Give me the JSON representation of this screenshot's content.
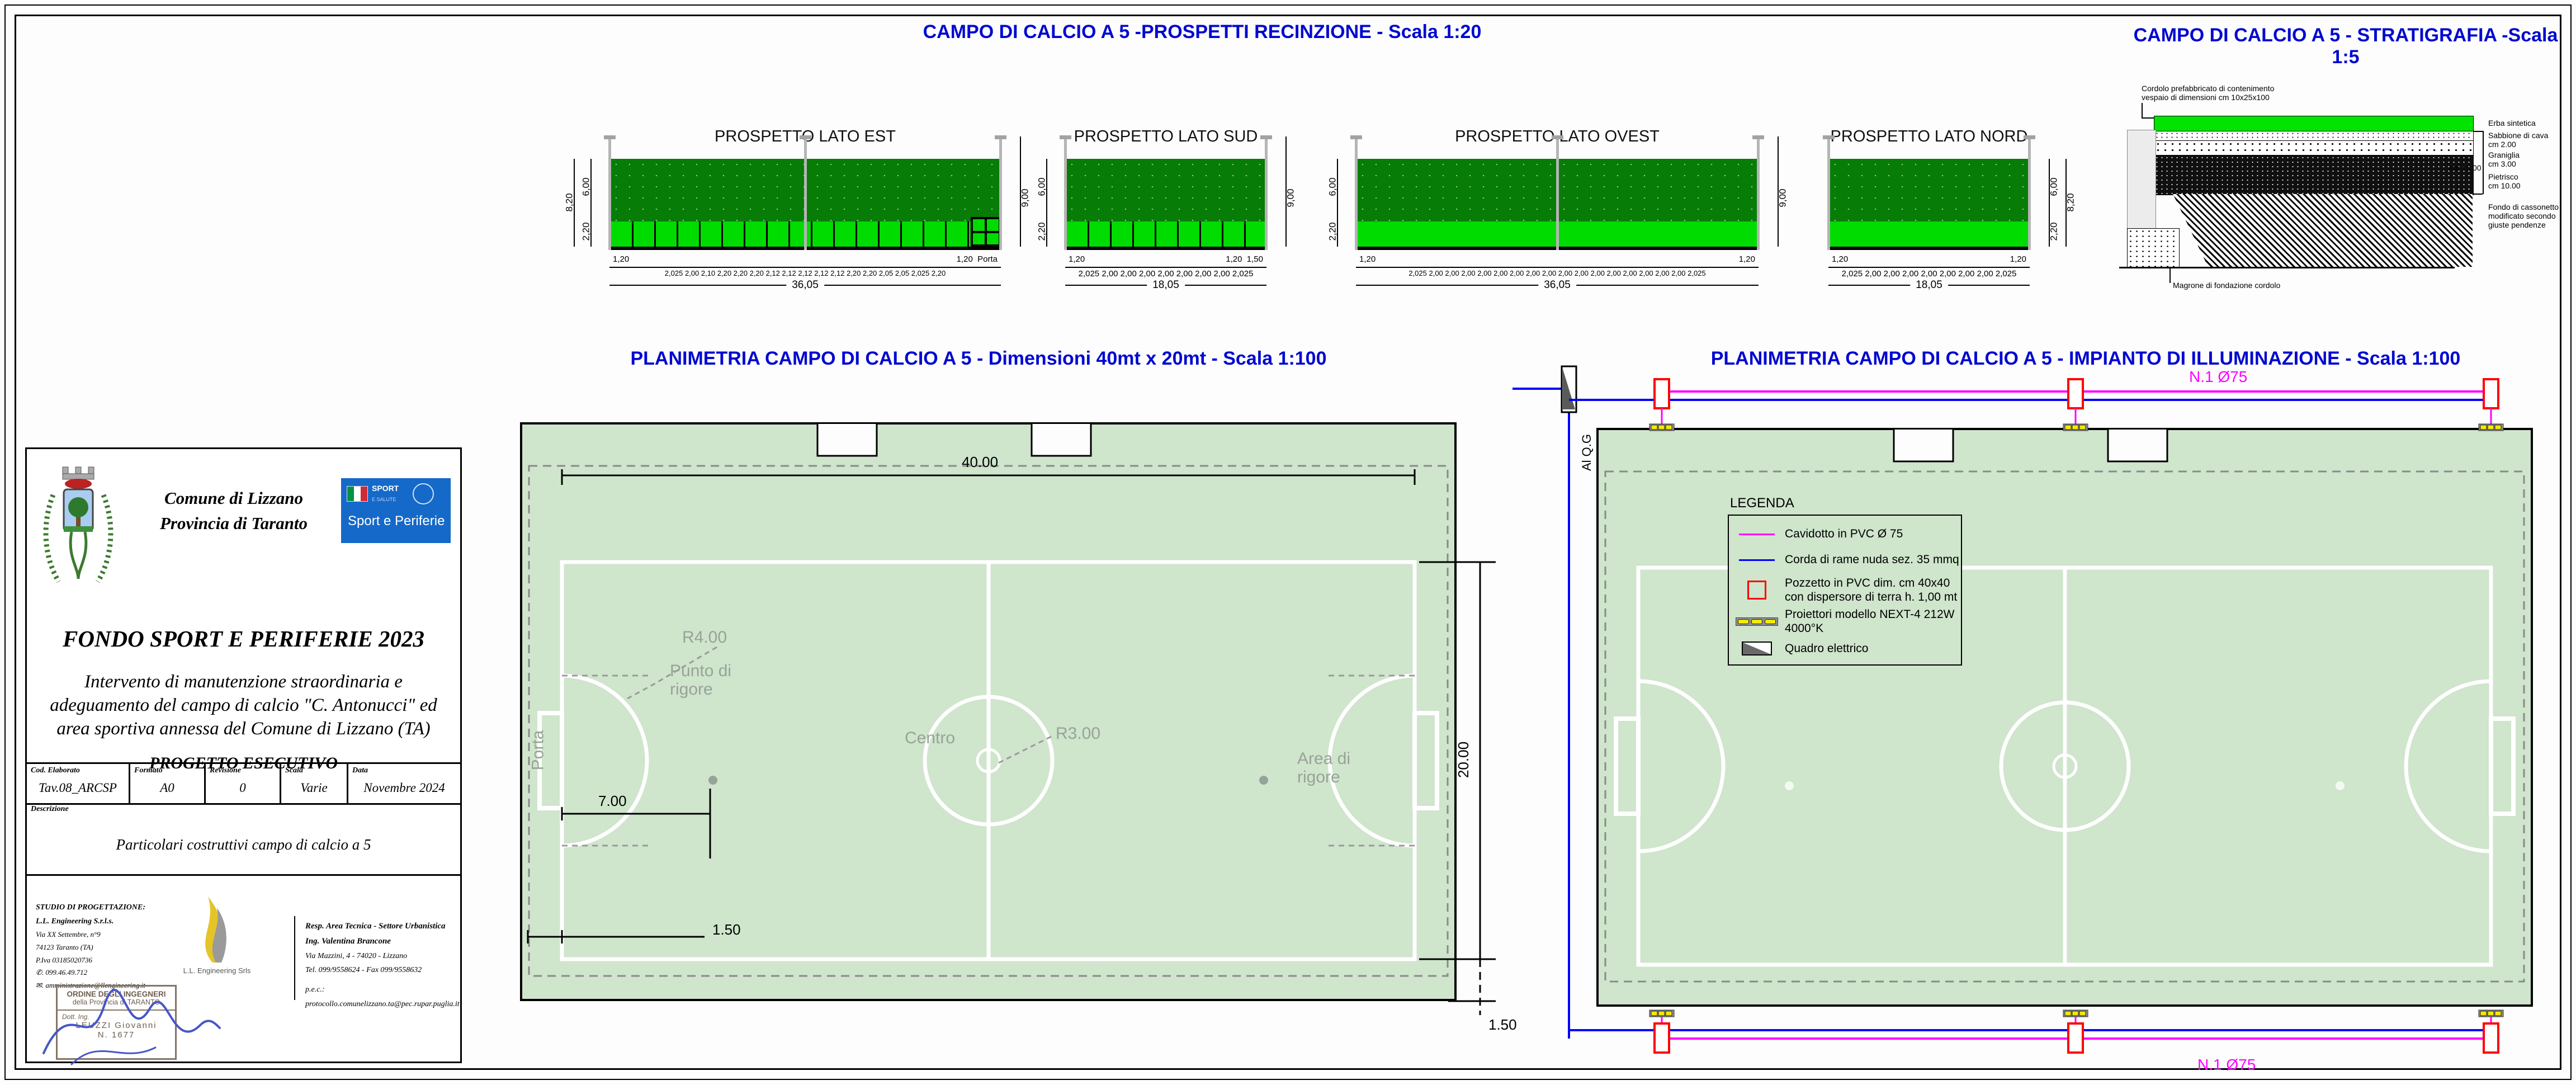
{
  "titles": {
    "prospetti": "CAMPO DI CALCIO A 5  -PROSPETTI RECINZIONE - Scala 1:20",
    "stratigrafia": "CAMPO DI CALCIO A 5 - STRATIGRAFIA -Scala 1:5",
    "planimetria": "PLANIMETRIA CAMPO DI CALCIO A 5 - Dimensioni 40mt x 20mt - Scala 1:100",
    "illuminazione": "PLANIMETRIA CAMPO DI CALCIO A 5 - IMPIANTO DI ILLUMINAZIONE - Scala 1:100"
  },
  "elevations": [
    {
      "title": "PROSPETTO LATO EST",
      "h_total": "8,20",
      "h_top": "6,00",
      "h_bottom": "2,20",
      "h_pole": "9,00",
      "module": "1,20",
      "extra": "Porta",
      "segments": "2,025  2,00  2,10  2,20  2,20  2,20  2,12  2,12  2,12  2,12  2,12  2,20  2,20  2,05  2,05  2,025  2,20",
      "w_total": "36,05"
    },
    {
      "title": "PROSPETTO LATO SUD",
      "h_total": "8,20",
      "h_top": "6,00",
      "h_bottom": "2,20",
      "h_pole": "9,00",
      "module": "1,20",
      "extra": "1,50",
      "segments": "2,025  2,00  2,00  2,00  2,00  2,00  2,00  2,00  2,025",
      "w_total": "18,05"
    },
    {
      "title": "PROSPETTO LATO OVEST",
      "h_total": "8,20",
      "h_top": "6,00",
      "h_bottom": "2,20",
      "h_pole": "9,00",
      "module": "1,20",
      "extra": "1,20",
      "segments": "2,025  2,00  2,00  2,00  2,00  2,00  2,00  2,00  2,00  2,00  2,00  2,00  2,00  2,00  2,00  2,00  2,00  2,025",
      "w_total": "36,05"
    },
    {
      "title": "PROSPETTO LATO NORD",
      "h_total": "8,20",
      "h_top": "6,00",
      "h_bottom": "2,20",
      "h_pole": "9,00",
      "module": "1,20",
      "extra": "1,20",
      "segments": "2,025  2,00  2,00  2,00  2,00  2,00  2,00  2,00  2,025",
      "w_total": "18,05"
    }
  ],
  "stratigraphy": {
    "label_cordolo": "Cordolo prefabbricato di contenimento\nvespaio di dimensioni cm 10x25x100",
    "layer_erba": "Erba sintetica",
    "layer_sabbione": "Sabbione di cava\ncm 2.00",
    "layer_graniglia": "Graniglia\ncm 3.00",
    "dim_totale": "cm 15.00",
    "layer_pietrisco": "Pietrisco\ncm 10.00",
    "label_fondo": "Fondo di cassonetto\nmodificato secondo\ngiuste pendenze",
    "label_magrone": "Magrone di fondazione cordolo"
  },
  "plan": {
    "porta": "Porta",
    "punto_di_rigore": "Punto di\nrigore",
    "centro": "Centro",
    "r3": "R3.00",
    "r4": "R4.00",
    "area_di_rigore": "Area di\nrigore",
    "dim_larghezza": "40.00",
    "dim_altezza": "20.00",
    "dim_punto": "7.00",
    "dim_fascia_sx": "1.50",
    "dim_fascia_basso": "1.50"
  },
  "lighting": {
    "quadro_label": "Al  Q.G",
    "cavidotto_top": "N.1 Ø75",
    "cavidotto_bottom": "N.1 Ø75",
    "legend": {
      "title": "LEGENDA",
      "items": [
        {
          "label": "Cavidotto in PVC Ø 75"
        },
        {
          "label": "Corda di rame nuda sez. 35 mmq"
        },
        {
          "label": "Pozzetto in PVC dim. cm 40x40",
          "label2": "con dispersore di terra h. 1,00 mt"
        },
        {
          "label": "Proiettori modello NEXT-4 212W 4000°K"
        },
        {
          "label": "Quadro elettrico"
        }
      ]
    }
  },
  "titleblock": {
    "comune": "Comune di Lizzano",
    "provincia": "Provincia di Taranto",
    "logo_line1": "SPORT",
    "logo_line2": "E SALUTE",
    "logo_text": "Sport e Periferie",
    "fondo": "FONDO SPORT E PERIFERIE 2023",
    "intervento": "Intervento di manutenzione straordinaria e\nadeguamento del campo di calcio \"C. Antonucci\" ed\narea sportiva annessa del Comune di Lizzano (TA)",
    "progetto": "PROGETTO ESECUTIVO",
    "campi": {
      "cod_label": "Cod. Elaborato",
      "cod": "Tav.08_ARCSP",
      "formato_label": "Formato",
      "formato": "A0",
      "revisione_label": "Revisione",
      "revisione": "0",
      "scala_label": "Scala",
      "scala": "Varie",
      "data_label": "Data",
      "data": "Novembre 2024"
    },
    "descrizione_label": "Descrizione",
    "descrizione": "Particolari costruttivi campo di calcio a 5",
    "studio": {
      "titolo": "STUDIO DI PROGETTAZIONE:",
      "nome": "L.L. Engineering S.r.l.s.",
      "via": "Via XX Settembre, n°9",
      "citta": "74123 Taranto (TA)",
      "piva": "P.Iva 03185020736",
      "tel": "✆. 099.46.49.712",
      "mail": "✉. amministrazione@llengineering.it",
      "logo_caption": "L.L. Engineering Srls"
    },
    "timbro": {
      "riga1": "ORDINE DEGLI INGEGNERI",
      "riga2": "della Provincia di TARANTO",
      "riga3": "Dott. Ing.",
      "riga4": "LEUZZI Giovanni",
      "riga5": "N. 1677"
    },
    "responsabile": {
      "riga1": "Resp. Area Tecnica - Settore Urbanistica",
      "riga2": "Ing. Valentina Brancone",
      "riga3": "Via Mazzini, 4 - 74020 - Lizzano",
      "riga4": "Tel. 099/9558624 - Fax 099/9558632",
      "riga5": "p.e.c.: protocollo.comunelizzano.ta@pec.rupar.puglia.it"
    }
  },
  "colors": {
    "title_blue": "#0008d0",
    "field_green": "#cfe5cc",
    "fence_dark": "#077c07",
    "fence_light": "#00dc00",
    "cavidotto_magenta": "#ff00ff",
    "corda_blue": "#0000ff",
    "pozzetto_red": "#ff0000"
  }
}
